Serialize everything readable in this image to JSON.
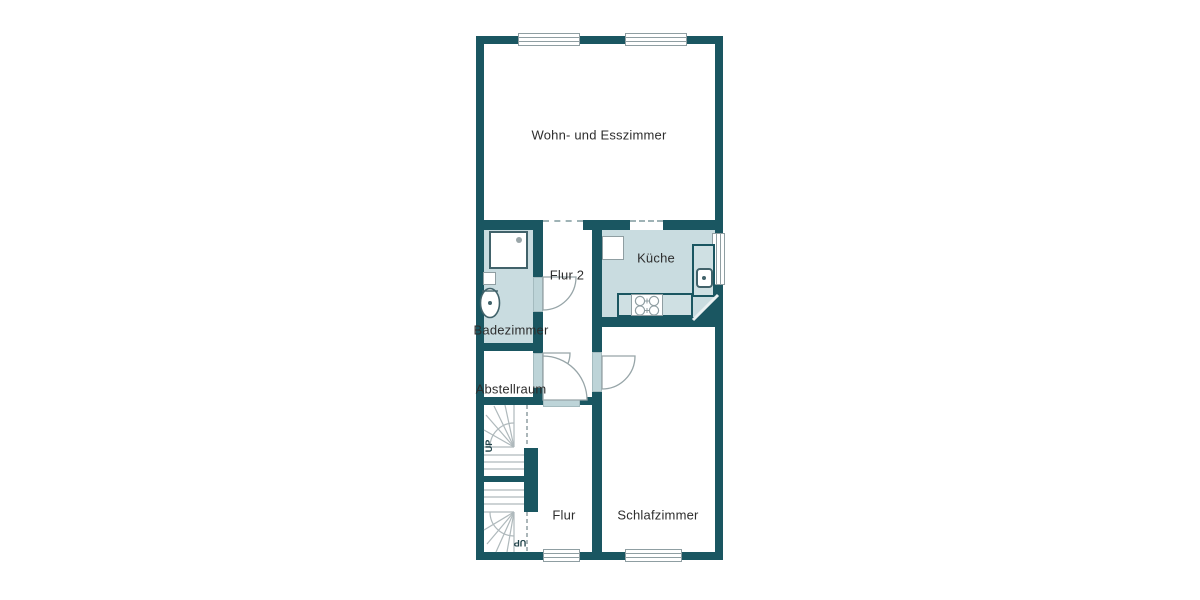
{
  "plan": {
    "type": "apartment-floor-plan",
    "language": "de"
  },
  "colors": {
    "wall": "#1A5661",
    "wet_room_floor": "#C9DCE0",
    "dry_room_floor": "#FFFFFF",
    "door_panel": "#BDD4D8",
    "counter_fill": "#CFE0E3",
    "outline_gray": "#8F9EA2",
    "label_text": "#2D2D2D"
  },
  "rooms": {
    "living": {
      "label": "Wohn- und Esszimmer"
    },
    "kitchen": {
      "label": "Küche"
    },
    "hallway2": {
      "label": "Flur 2"
    },
    "bathroom": {
      "label": "Badezimmer"
    },
    "storage": {
      "label": "Abstellraum"
    },
    "hallway": {
      "label": "Flur"
    },
    "bedroom": {
      "label": "Schlafzimmer"
    }
  },
  "stairs": {
    "upper_label": "UP",
    "lower_label": "UP"
  },
  "fixtures": {
    "bathroom": [
      "shower",
      "toilet",
      "cabinet"
    ],
    "kitchen": [
      "refrigerator",
      "counter-right",
      "counter-bottom",
      "sink",
      "stove",
      "corner-cabinet"
    ]
  },
  "openings": {
    "windows": [
      "living-top-left",
      "living-top-right",
      "kitchen-right",
      "hallway-bottom",
      "bedroom-bottom"
    ],
    "doors": [
      "bathroom",
      "storage",
      "hallway",
      "bedroom"
    ],
    "passages": [
      "living-to-hallway2",
      "living-to-kitchen"
    ]
  }
}
